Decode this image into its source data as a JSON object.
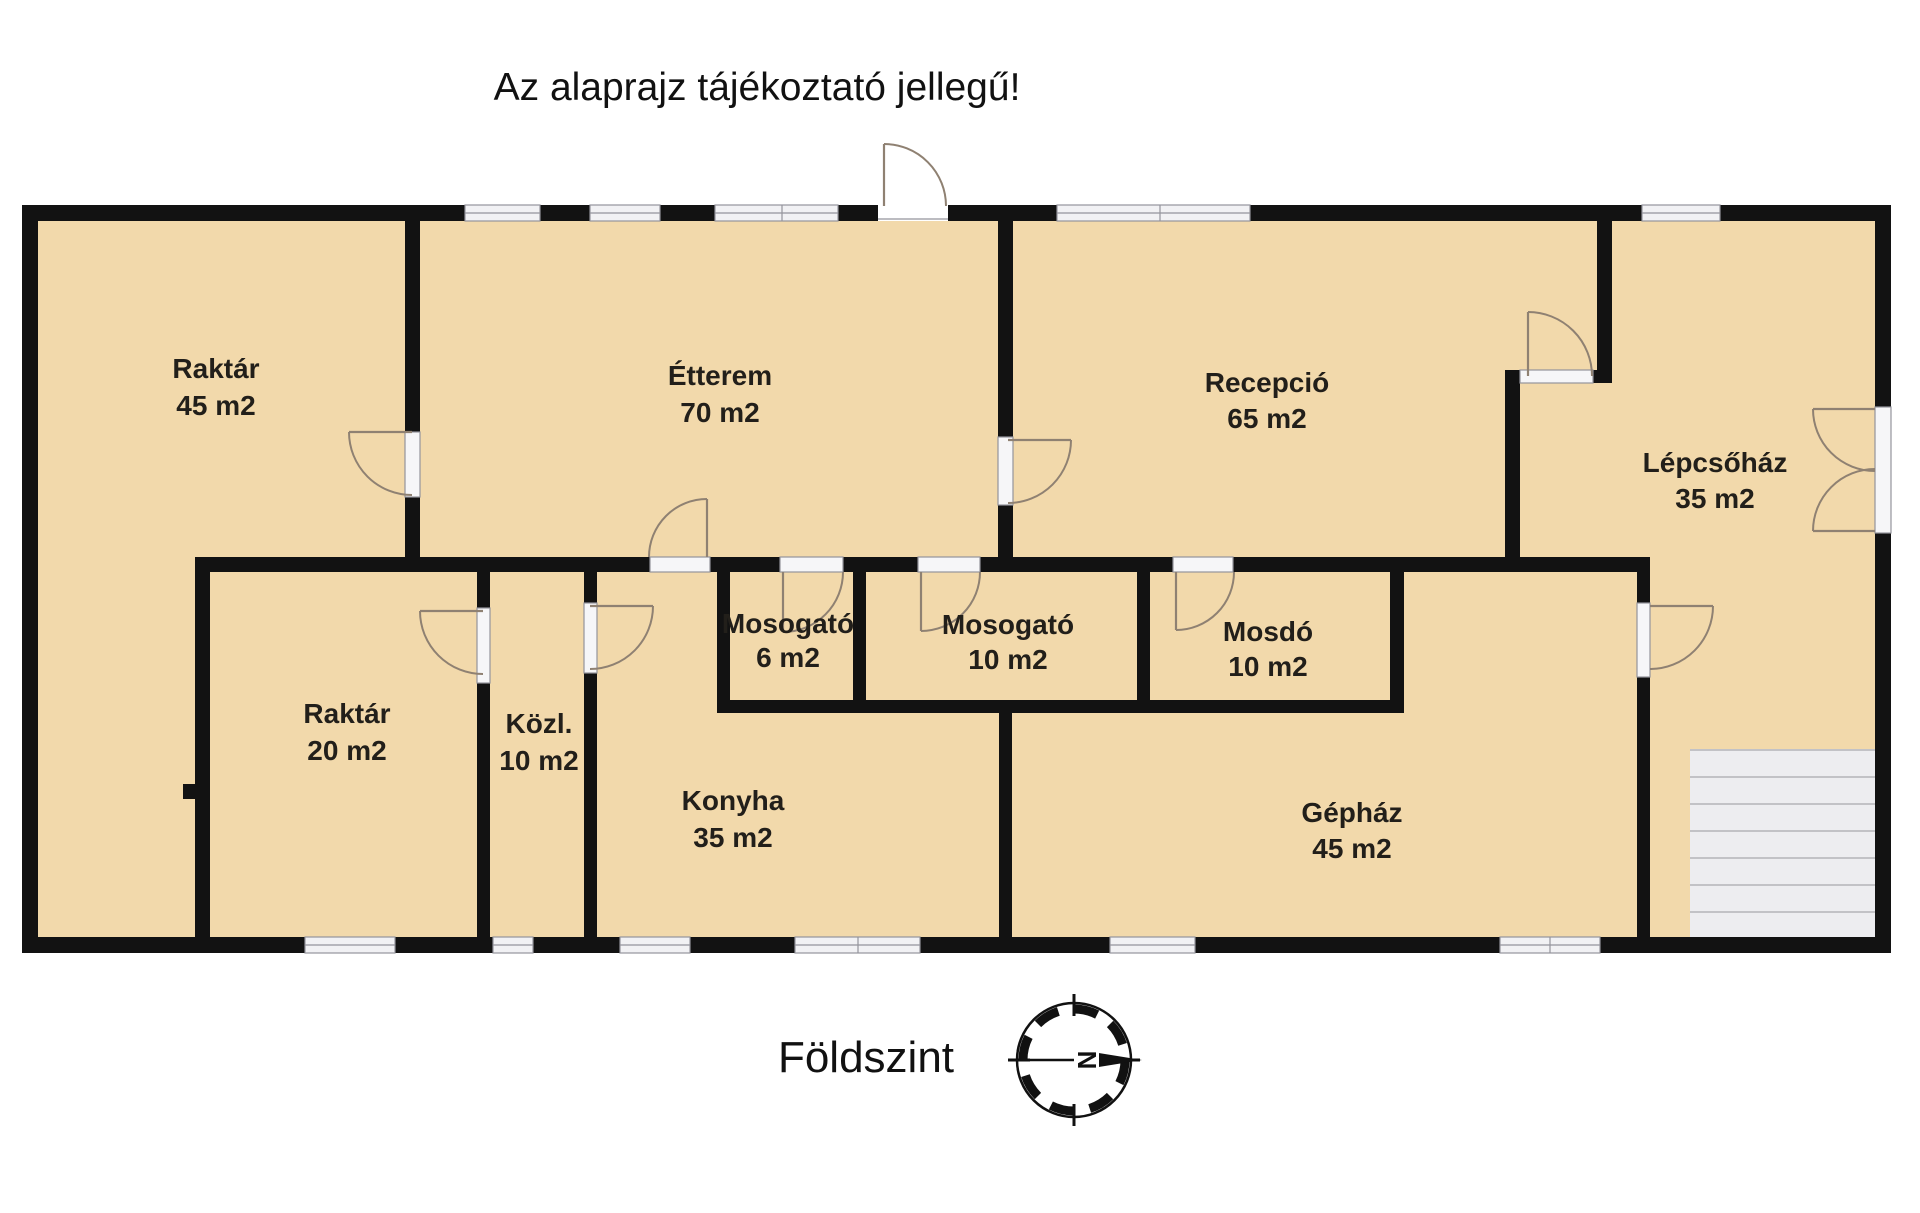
{
  "title": "Az alaprajz tájékoztató jellegű!",
  "floor_label": "Földszint",
  "compass": {
    "north_letter": "N"
  },
  "rooms": [
    {
      "id": "raktar-45",
      "name": "Raktár",
      "area": "45 m2"
    },
    {
      "id": "etterem",
      "name": "Étterem",
      "area": "70 m2"
    },
    {
      "id": "recepcio",
      "name": "Recepció",
      "area": "65 m2"
    },
    {
      "id": "lepcsohaz",
      "name": "Lépcsőház",
      "area": "35 m2"
    },
    {
      "id": "raktar-20",
      "name": "Raktár",
      "area": "20 m2"
    },
    {
      "id": "kozl",
      "name": "Közl.",
      "area": "10 m2"
    },
    {
      "id": "mosogato-6",
      "name": "Mosogató",
      "area": "6 m2"
    },
    {
      "id": "mosogato-10",
      "name": "Mosogató",
      "area": "10 m2"
    },
    {
      "id": "mosdo",
      "name": "Mosdó",
      "area": "10 m2"
    },
    {
      "id": "konyha",
      "name": "Konyha",
      "area": "35 m2"
    },
    {
      "id": "gephaz",
      "name": "Gépház",
      "area": "45 m2"
    }
  ],
  "colors": {
    "background": "#ffffff",
    "floor": "#f2d9ab",
    "wall": "#121212",
    "window_fill": "#f1f1f4",
    "doorframe_fill": "#f6f6f8",
    "frame_line": "#94949c",
    "door_line": "#8f8172",
    "stairs_fill": "#ededf0",
    "stairs_line": "#c2c2c6",
    "text": "#221f1a",
    "title_text": "#111111"
  }
}
